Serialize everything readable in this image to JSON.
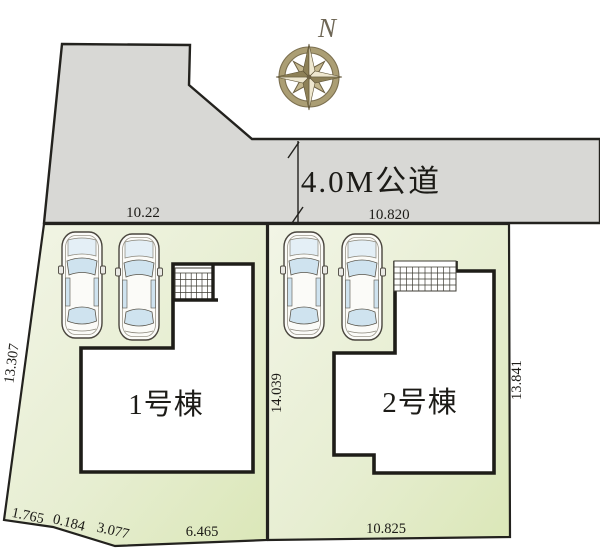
{
  "road": {
    "label": "4.0M公道"
  },
  "compass": {
    "north_label": "N"
  },
  "buildings": [
    {
      "label": "1号棟"
    },
    {
      "label": "2号棟"
    }
  ],
  "dimensions": {
    "road_frontage_left": "10.22",
    "road_frontage_right": "10.820",
    "lot1_west": "13.307",
    "lot1_east": "14.039",
    "lot2_east": "13.841",
    "lot1_south_segments": [
      "1.765",
      "0.184",
      "3.077",
      "6.465"
    ],
    "lot2_south": "10.825"
  },
  "colors": {
    "road_fill": "#d8d8d5",
    "lot_fill_light": "#f2f5e6",
    "lot_fill_dark": "#dbe7b8",
    "outline": "#23221e",
    "car_window": "#cfe3ef",
    "compass_light": "#eee7cf",
    "compass_dark": "#8d8057",
    "compass_ring": "#ab9e74"
  }
}
